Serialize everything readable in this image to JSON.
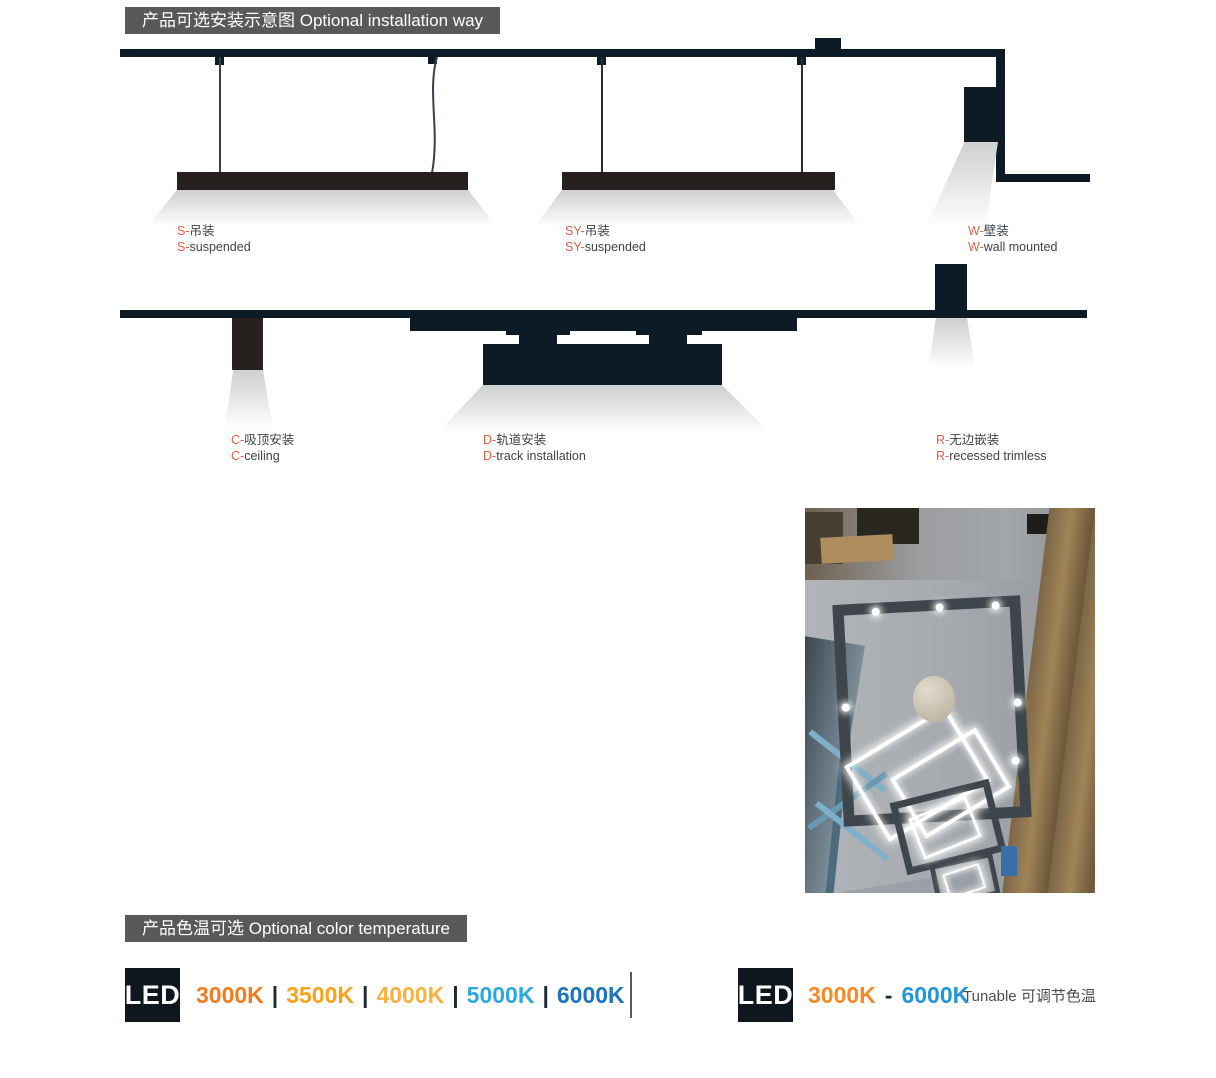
{
  "installation": {
    "header": "产品可选安装示意图 Optional installation way",
    "accent_color": "#e06049",
    "header_bg": "#58595b",
    "items": [
      {
        "prefix": "S-",
        "zh": "吊装",
        "en": "suspended"
      },
      {
        "prefix": "SY-",
        "zh": "吊装",
        "en": "suspended"
      },
      {
        "prefix": "W-",
        "zh": "壁装",
        "en": "wall mounted"
      },
      {
        "prefix": "C-",
        "zh": "吸顶安装",
        "en": "ceiling"
      },
      {
        "prefix": "D-",
        "zh": "轨道安装",
        "en": "track installation"
      },
      {
        "prefix": "R-",
        "zh": "无边嵌装",
        "en": "recessed trimless"
      }
    ]
  },
  "color_temperature": {
    "header": "产品色温可选 Optional color temperature",
    "fixed": {
      "badge": "LED",
      "separator": "|",
      "options": [
        {
          "label": "3000K",
          "color": "#f47b20"
        },
        {
          "label": "3500K",
          "color": "#f9a21b"
        },
        {
          "label": "4000K",
          "color": "#fbb042"
        },
        {
          "label": "5000K",
          "color": "#2ba9e0"
        },
        {
          "label": "6000K",
          "color": "#1c74bc"
        }
      ]
    },
    "tunable": {
      "badge": "LED",
      "from": {
        "label": "3000K",
        "color": "#f68b28"
      },
      "dash": "-",
      "to": {
        "label": "6000K",
        "color": "#2196d9"
      },
      "note": "Tunable 可调节色温"
    }
  }
}
